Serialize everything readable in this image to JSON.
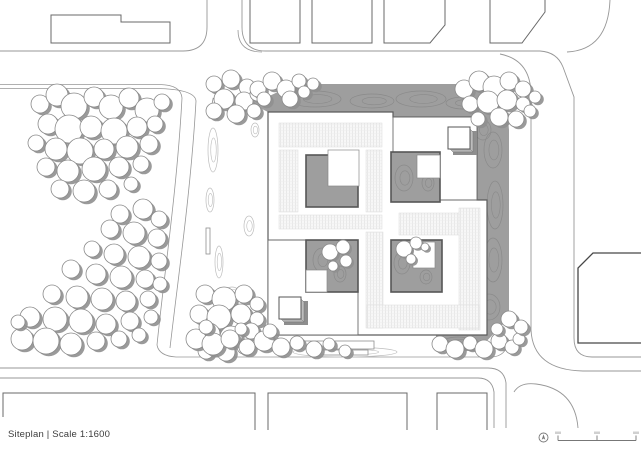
{
  "meta": {
    "title_text": "Siteplan | Scale 1:1600"
  },
  "colors": {
    "background": "#ffffff",
    "road": "#979797",
    "boundary": "#9c9c9c",
    "context_building": "#686868",
    "dark_building": "#474747",
    "site_gray": "#9e9e9e",
    "contour_dark": "#8a8a8a",
    "contour_light": "#bdbdbd",
    "museum_outline": "#5c5c5c",
    "courtyard_stroke": "#565656",
    "tree_stroke": "#8a8a8a",
    "tree_shadow": "#8f8f8f",
    "cube_shadow": "#8e8e8e",
    "cube_side": "#bdbdbd",
    "text": "#3c3c3c"
  },
  "plan": {
    "roads": [
      {
        "d": "M207,0 V27 Q207,51 183,51 H0",
        "w": 0.9
      },
      {
        "d": "M242,0 V27 Q242,51 266,51 H540",
        "w": 0.9
      },
      {
        "d": "M540,51 Q557,52 563,67 L574,97 V338 Q574,357 592,357 H641",
        "w": 0.9
      },
      {
        "d": "M531,95 Q531,60 500,54",
        "w": 0.9
      },
      {
        "d": "M531,95 V330",
        "w": 0.9
      },
      {
        "d": "M531,330 Q533,370 583,371 H641",
        "w": 0.9
      },
      {
        "d": "M567,52 Q608,50 610,0",
        "w": 0.9
      },
      {
        "d": "M0,84.5 H160 Q181,85 182,98",
        "w": 0.8
      },
      {
        "d": "M0,88.5 H156 Q195,89 196,101",
        "w": 0.8
      },
      {
        "d": "M182,98 C177,190 164,275 157,345",
        "w": 0.8
      },
      {
        "d": "M196,101 C191,190 178,278 170,348",
        "w": 0.8
      },
      {
        "d": "M157,345 Q159,356 176,357 H492 Q506,356 508,342",
        "w": 0.8
      },
      {
        "d": "M0,368 H488 Q504,368 506,383 V428",
        "w": 0.9
      },
      {
        "d": "M0,378 H478 Q492,378 494,392 V428",
        "w": 0.9
      },
      {
        "d": "M578,428 Q575,389 536,384 Q520,382 514,392",
        "w": 0.9
      },
      {
        "d": "M238,30 Q238,52 262,52",
        "w": 0.8
      }
    ],
    "context_buildings": [
      {
        "d": "M51,15 H121 V22 H170 V43 H51 Z",
        "w": 1.0,
        "dark": false
      },
      {
        "d": "M250,0 V43 H300 V0",
        "w": 1.0,
        "dark": false
      },
      {
        "d": "M312,0 V43 H372 V0",
        "w": 1.0,
        "dark": false
      },
      {
        "d": "M384,0 V43 H430 L445,25 V0",
        "w": 1.0,
        "dark": false
      },
      {
        "d": "M490,0 V43 H522 L545,12 V0",
        "w": 1.0,
        "dark": false
      },
      {
        "d": "M641,253 H593 L578,268 V343 H641",
        "w": 1.3,
        "dark": true
      },
      {
        "d": "M3,417 V393 H255 V430",
        "w": 1.0,
        "dark": false
      },
      {
        "d": "M268,430 V393 H407 V430",
        "w": 1.0,
        "dark": false
      },
      {
        "d": "M437,430 V393 H487 V430",
        "w": 1.0,
        "dark": false
      }
    ],
    "site_gray_polygon": "M252,104 L295,84 L470,84 Q502,86 506,98 L509,130 V318 L477,351 L436,351 V335 H268 V112 Z",
    "contours_dark": [
      [
        315,
        99,
        26,
        8
      ],
      [
        372,
        101,
        22,
        7
      ],
      [
        421,
        99,
        25,
        8
      ],
      [
        463,
        103,
        17,
        6
      ],
      [
        296,
        94,
        9,
        4
      ],
      [
        493,
        150,
        9,
        18
      ],
      [
        495,
        205,
        8,
        24
      ],
      [
        493,
        260,
        9,
        22
      ],
      [
        489,
        307,
        11,
        13
      ],
      [
        483,
        130,
        8,
        10
      ],
      [
        404,
        178,
        9,
        13
      ],
      [
        428,
        183,
        6,
        8
      ],
      [
        322,
        260,
        9,
        12
      ],
      [
        340,
        274,
        6,
        8
      ],
      [
        402,
        263,
        8,
        11
      ],
      [
        426,
        277,
        6,
        7
      ],
      [
        430,
        250,
        4,
        6
      ],
      [
        458,
        342,
        15,
        5
      ],
      [
        449,
        207,
        7,
        4
      ]
    ],
    "contours_light": [
      [
        213,
        150,
        5,
        22
      ],
      [
        219,
        262,
        4,
        16
      ],
      [
        232,
        292,
        7,
        5
      ],
      [
        249,
        226,
        5,
        10
      ],
      [
        345,
        352,
        52,
        5
      ],
      [
        331,
        346,
        28,
        4
      ],
      [
        240,
        110,
        6,
        9
      ],
      [
        255,
        130,
        4,
        7
      ],
      [
        210,
        200,
        4,
        12
      ]
    ],
    "museum": {
      "outline_d": "M268,112 H393 V117 H477 V200 H487 V335 H268 Z",
      "hatch_rects": [
        [
          279,
          123,
          103,
          24
        ],
        [
          279,
          150,
          19,
          62
        ],
        [
          366,
          150,
          16,
          62
        ],
        [
          279,
          215,
          103,
          14
        ],
        [
          366,
          232,
          17,
          96
        ],
        [
          399,
          213,
          62,
          22
        ],
        [
          459,
          208,
          21,
          122
        ],
        [
          367,
          305,
          112,
          23
        ]
      ],
      "white_blocks": [
        "M393,117 H477 V200 H440 V152 H393 Z",
        "M268,240 H358 V335 H268 Z"
      ],
      "courtyards": [
        [
          306,
          155,
          52,
          52
        ],
        [
          391,
          152,
          49,
          50
        ],
        [
          306,
          240,
          52,
          52
        ],
        [
          391,
          240,
          51,
          52
        ]
      ],
      "notches": [
        [
          328,
          150,
          31,
          36
        ],
        [
          417,
          155,
          23,
          23
        ],
        [
          306,
          270,
          21,
          22
        ],
        [
          413,
          242,
          22,
          26
        ]
      ],
      "cubes": [
        {
          "x": 448,
          "y": 127,
          "s": 22
        },
        {
          "x": 279,
          "y": 297,
          "s": 22
        }
      ],
      "misc_rects": [
        {
          "x": 211,
          "y": 99,
          "w": 9,
          "h": 20,
          "rot": 12
        },
        {
          "x": 206,
          "y": 228,
          "w": 4,
          "h": 26,
          "rot": 0
        },
        {
          "x": 224,
          "y": 330,
          "w": 8,
          "h": 8,
          "rot": 0
        },
        {
          "x": 296,
          "y": 341,
          "w": 78,
          "h": 8,
          "rot": 0
        },
        {
          "x": 318,
          "y": 350,
          "w": 50,
          "h": 5,
          "rot": 0
        }
      ]
    },
    "trees": {
      "site": [
        [
          40,
          104,
          9
        ],
        [
          57,
          95,
          11
        ],
        [
          74,
          106,
          13
        ],
        [
          94,
          97,
          10
        ],
        [
          111,
          107,
          12
        ],
        [
          129,
          98,
          10
        ],
        [
          147,
          110,
          12
        ],
        [
          162,
          102,
          8
        ],
        [
          48,
          124,
          10
        ],
        [
          69,
          129,
          14
        ],
        [
          91,
          127,
          11
        ],
        [
          114,
          131,
          13
        ],
        [
          137,
          127,
          10
        ],
        [
          155,
          124,
          8
        ],
        [
          36,
          143,
          8
        ],
        [
          56,
          149,
          11
        ],
        [
          80,
          151,
          13
        ],
        [
          104,
          149,
          10
        ],
        [
          127,
          147,
          11
        ],
        [
          149,
          144,
          9
        ],
        [
          46,
          167,
          9
        ],
        [
          68,
          171,
          11
        ],
        [
          94,
          169,
          12
        ],
        [
          119,
          167,
          10
        ],
        [
          141,
          164,
          8
        ],
        [
          60,
          189,
          9
        ],
        [
          84,
          191,
          11
        ],
        [
          108,
          189,
          9
        ],
        [
          131,
          184,
          7
        ],
        [
          120,
          214,
          9
        ],
        [
          143,
          209,
          10
        ],
        [
          159,
          219,
          8
        ],
        [
          110,
          229,
          9
        ],
        [
          134,
          233,
          11
        ],
        [
          157,
          238,
          9
        ],
        [
          92,
          249,
          8
        ],
        [
          114,
          254,
          10
        ],
        [
          139,
          257,
          11
        ],
        [
          159,
          261,
          8
        ],
        [
          71,
          269,
          9
        ],
        [
          96,
          274,
          10
        ],
        [
          121,
          277,
          11
        ],
        [
          145,
          279,
          9
        ],
        [
          160,
          284,
          7
        ],
        [
          52,
          294,
          9
        ],
        [
          77,
          297,
          11
        ],
        [
          102,
          299,
          11
        ],
        [
          126,
          301,
          10
        ],
        [
          148,
          299,
          8
        ],
        [
          30,
          317,
          10
        ],
        [
          55,
          319,
          12
        ],
        [
          81,
          321,
          12
        ],
        [
          106,
          324,
          10
        ],
        [
          130,
          321,
          9
        ],
        [
          151,
          317,
          7
        ],
        [
          22,
          339,
          11
        ],
        [
          46,
          341,
          13
        ],
        [
          71,
          344,
          11
        ],
        [
          96,
          341,
          9
        ],
        [
          119,
          339,
          8
        ],
        [
          139,
          335,
          7
        ],
        [
          18,
          322,
          7
        ],
        [
          205,
          294,
          9
        ],
        [
          224,
          299,
          12
        ],
        [
          244,
          294,
          9
        ],
        [
          257,
          304,
          7
        ],
        [
          199,
          314,
          9
        ],
        [
          219,
          317,
          12
        ],
        [
          241,
          314,
          10
        ],
        [
          257,
          319,
          7
        ],
        [
          209,
          334,
          11
        ],
        [
          231,
          337,
          11
        ],
        [
          251,
          331,
          8
        ],
        [
          206,
          351,
          8
        ],
        [
          226,
          352,
          9
        ],
        [
          244,
          347,
          7
        ],
        [
          262,
          342,
          6
        ],
        [
          214,
          84,
          8
        ],
        [
          231,
          79,
          9
        ],
        [
          247,
          87,
          8
        ],
        [
          224,
          99,
          10
        ],
        [
          244,
          101,
          9
        ],
        [
          257,
          94,
          7
        ],
        [
          214,
          111,
          8
        ],
        [
          236,
          114,
          9
        ],
        [
          254,
          111,
          7
        ],
        [
          258,
          89,
          8
        ],
        [
          272,
          81,
          9
        ],
        [
          286,
          89,
          9
        ],
        [
          299,
          81,
          7
        ],
        [
          264,
          99,
          7
        ],
        [
          290,
          99,
          8
        ],
        [
          304,
          92,
          6
        ],
        [
          313,
          84,
          6
        ],
        [
          464,
          89,
          9
        ],
        [
          479,
          81,
          10
        ],
        [
          494,
          87,
          11
        ],
        [
          509,
          81,
          9
        ],
        [
          523,
          89,
          8
        ],
        [
          470,
          104,
          8
        ],
        [
          488,
          102,
          11
        ],
        [
          507,
          100,
          10
        ],
        [
          523,
          104,
          7
        ],
        [
          499,
          117,
          9
        ],
        [
          516,
          119,
          8
        ],
        [
          530,
          111,
          6
        ],
        [
          478,
          119,
          7
        ],
        [
          535,
          97,
          6
        ],
        [
          196,
          339,
          10
        ],
        [
          213,
          344,
          11
        ],
        [
          230,
          339,
          9
        ],
        [
          247,
          347,
          8
        ],
        [
          264,
          341,
          10
        ],
        [
          281,
          347,
          9
        ],
        [
          297,
          343,
          7
        ],
        [
          314,
          349,
          8
        ],
        [
          329,
          344,
          6
        ],
        [
          206,
          327,
          7
        ],
        [
          241,
          329,
          6
        ],
        [
          270,
          331,
          7
        ],
        [
          345,
          351,
          6
        ],
        [
          440,
          344,
          8
        ],
        [
          455,
          349,
          9
        ],
        [
          470,
          343,
          7
        ],
        [
          484,
          349,
          9
        ],
        [
          499,
          341,
          8
        ],
        [
          512,
          347,
          7
        ],
        [
          497,
          329,
          6
        ],
        [
          519,
          339,
          6
        ],
        [
          509,
          319,
          8
        ],
        [
          521,
          327,
          7
        ]
      ],
      "courtyard": [
        [
          330,
          252,
          8
        ],
        [
          343,
          247,
          7
        ],
        [
          346,
          261,
          6
        ],
        [
          333,
          266,
          5
        ],
        [
          404,
          249,
          8
        ],
        [
          416,
          243,
          6
        ],
        [
          411,
          259,
          5
        ],
        [
          425,
          247,
          4
        ]
      ]
    },
    "scalebar": {
      "x1": 558,
      "x2": 636,
      "y": 440.5,
      "tick_h": 5,
      "ticks": [
        558,
        597,
        636
      ],
      "north": {
        "cx": 543.5,
        "cy": 437.5,
        "r": 4.5
      }
    }
  }
}
